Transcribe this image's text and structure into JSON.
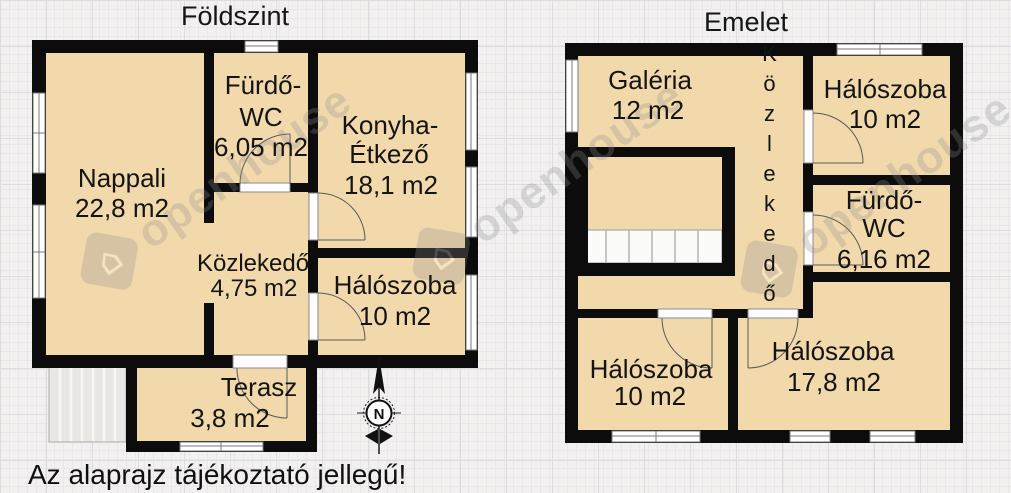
{
  "floors": {
    "foldszint": {
      "title": "Földszint",
      "rooms": {
        "nappali": {
          "name": "Nappali",
          "area": "22,8 m2"
        },
        "furdo_wc": {
          "line1": "Fürdő-",
          "line2": "WC",
          "area": "6,05 m2"
        },
        "konyha": {
          "line1": "Konyha-",
          "line2": "Étkező",
          "area": "18,1 m2"
        },
        "kozlekedo": {
          "name": "Közlekedő",
          "area": "4,75 m2"
        },
        "haloszoba": {
          "name": "Hálószoba",
          "area": "10 m2"
        },
        "terasz": {
          "name": "Terasz",
          "area": "3,8 m2"
        }
      }
    },
    "emelet": {
      "title": "Emelet",
      "rooms": {
        "galeria": {
          "name": "Galéria",
          "area": "12 m2"
        },
        "kozlekedo": {
          "name": "Közlekedő"
        },
        "haloszoba_fent": {
          "name": "Hálószoba",
          "area": "10 m2"
        },
        "furdo_wc": {
          "line1": "Fürdő-",
          "line2": "WC",
          "area": "6,16 m2"
        },
        "haloszoba_bal": {
          "name": "Hálószoba",
          "area": "10 m2"
        },
        "haloszoba_nagy": {
          "name": "Hálószoba",
          "area": "17,8 m2"
        }
      }
    }
  },
  "compass": {
    "north": "N"
  },
  "watermark": {
    "text": "openhouse",
    "house_glyph": "⌂"
  },
  "disclaimer": "Az alaprajz tájékoztató jellegű!",
  "colors": {
    "room_fill": "#f2d9ab",
    "wall": "#0c0c0c",
    "background": "#f2f1ef",
    "window_frame": "#7a7a7a",
    "door_arc": "#5a5a5a"
  }
}
